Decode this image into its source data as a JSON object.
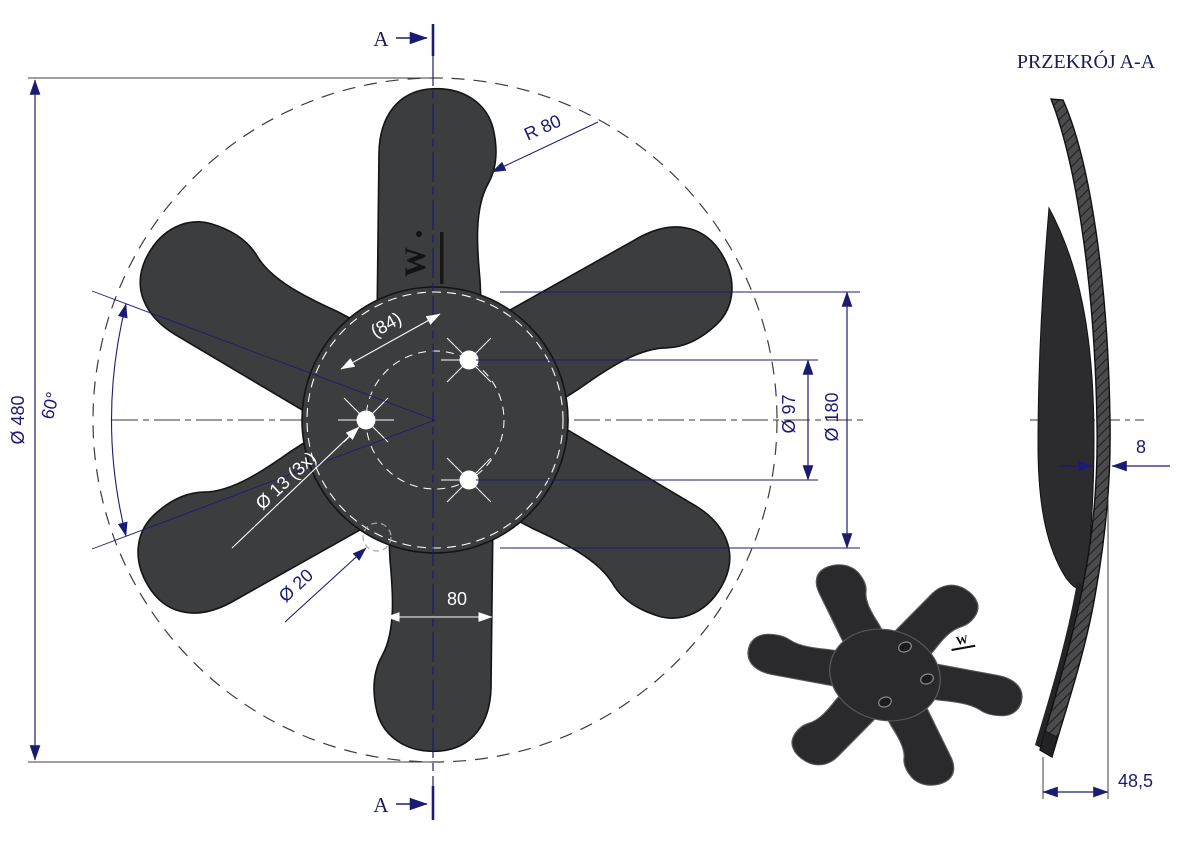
{
  "drawing": {
    "section_marker_label": "A",
    "section_title": "PRZEKRÓJ A-A",
    "logo_mark": "W",
    "front_view": {
      "outer_diameter": "Ø 480",
      "blade_pitch_angle": "60°",
      "blade_tip_radius": "R 80",
      "hole_spacing": "(84)",
      "mount_hole_diameter": "Ø 13 (3x)",
      "hidden_hole_diameter": "Ø 20",
      "blade_width": "80",
      "bolt_circle_diameter": "Ø 97",
      "hub_diameter": "Ø 180"
    },
    "section_view": {
      "plate_thickness": "8",
      "profile_depth": "48,5"
    },
    "colors": {
      "dimension_navy": "#1b1b73",
      "fan_body": "#3c3d3f",
      "white_dimension": "#ffffff",
      "section_fill": "#4b4b4d"
    }
  }
}
